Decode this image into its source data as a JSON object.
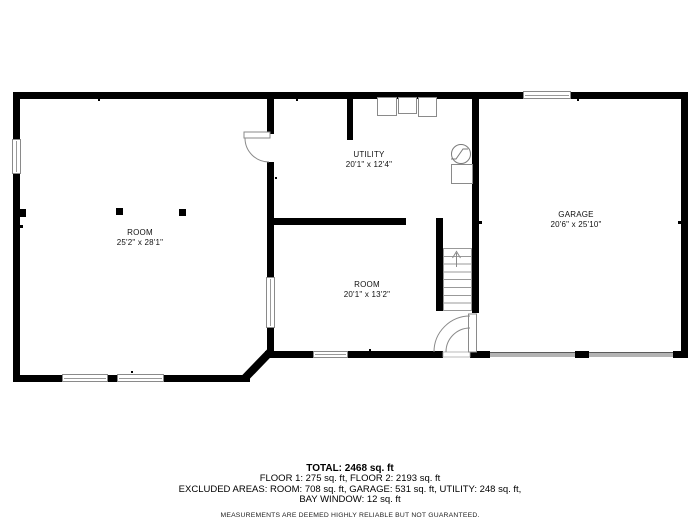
{
  "plan": {
    "rooms": [
      {
        "id": "room-left",
        "name": "ROOM",
        "dimensions": "25'2\" x 28'1\""
      },
      {
        "id": "utility",
        "name": "UTILITY",
        "dimensions": "20'1\" x 12'4\""
      },
      {
        "id": "room-middle",
        "name": "ROOM",
        "dimensions": "20'1\" x 13'2\""
      },
      {
        "id": "garage",
        "name": "GARAGE",
        "dimensions": "20'6\" x 25'10\""
      }
    ],
    "icons": {
      "water_heater": "water-heater-circle-symbol",
      "stairs": "staircase-up-arrow"
    },
    "colors": {
      "wall": "#000000",
      "window_outline": "#8a8a8a",
      "garage_door": "#b3b3b3",
      "text": "#111111"
    }
  },
  "summary": {
    "total": "TOTAL: 2468 sq. ft",
    "floors": "FLOOR 1: 275 sq. ft, FLOOR 2: 2193 sq. ft",
    "excluded_line1": "EXCLUDED AREAS: ROOM: 708 sq. ft, GARAGE: 531 sq. ft, UTILITY: 248 sq. ft,",
    "excluded_line2": "BAY WINDOW: 12 sq. ft",
    "disclaimer": "MEASUREMENTS ARE DEEMED HIGHLY RELIABLE BUT NOT GUARANTEED."
  }
}
